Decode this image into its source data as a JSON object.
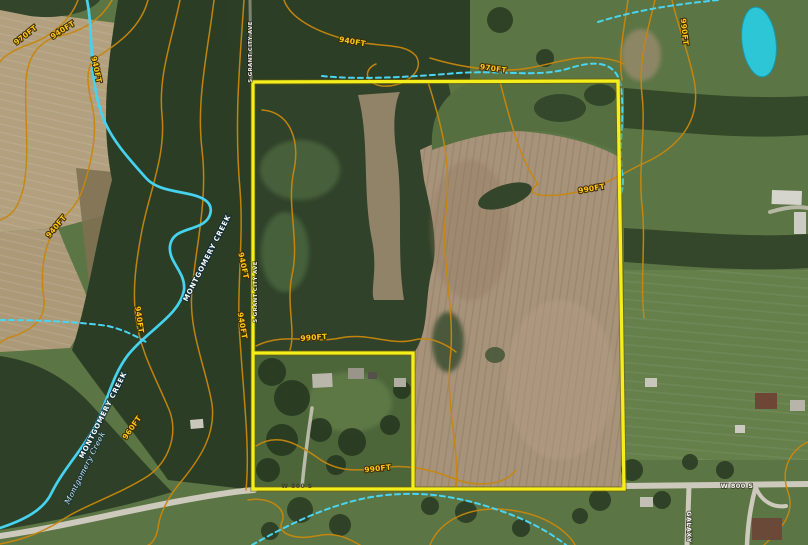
{
  "map": {
    "type": "aerial-parcel-map",
    "boundary_color": "#f6ee1b",
    "contour_color": "#c8870d",
    "creek_color": "#46d3f0",
    "pond_color": "#2cc6d6",
    "contour_labels": [
      {
        "text": "970FT",
        "x": 27,
        "y": 37,
        "r": -38
      },
      {
        "text": "940FT",
        "x": 64,
        "y": 32,
        "r": -33
      },
      {
        "text": "940FT",
        "x": 94,
        "y": 70,
        "r": 78
      },
      {
        "text": "940FT",
        "x": 352,
        "y": 44,
        "r": 10
      },
      {
        "text": "970FT",
        "x": 493,
        "y": 71,
        "r": 8
      },
      {
        "text": "990FT",
        "x": 682,
        "y": 32,
        "r": 84
      },
      {
        "text": "990FT",
        "x": 592,
        "y": 191,
        "r": -10
      },
      {
        "text": "940FT",
        "x": 241,
        "y": 266,
        "r": 78
      },
      {
        "text": "940FT",
        "x": 58,
        "y": 228,
        "r": -50
      },
      {
        "text": "940FT",
        "x": 137,
        "y": 320,
        "r": 82
      },
      {
        "text": "940FT",
        "x": 240,
        "y": 326,
        "r": 80
      },
      {
        "text": "990FT",
        "x": 314,
        "y": 340,
        "r": -4
      },
      {
        "text": "990FT",
        "x": 378,
        "y": 471,
        "r": -6
      },
      {
        "text": "960FT",
        "x": 134,
        "y": 429,
        "r": -55
      }
    ],
    "creek_labels": [
      {
        "text": "MONTGOMERY CREEK",
        "x": 209,
        "y": 259,
        "r": -63,
        "style": "creek-bold"
      },
      {
        "text": "MONTGOMERY CREEK",
        "x": 105,
        "y": 416,
        "r": -63,
        "style": "creek-bold"
      },
      {
        "text": "Montgomery Creek",
        "x": 87,
        "y": 469,
        "r": -63,
        "style": "creek-italic"
      }
    ],
    "road_labels": [
      {
        "text": "W 800 S",
        "x": 737,
        "y": 488,
        "r": 0,
        "style": "road-light"
      },
      {
        "text": "W 800 S",
        "x": 297,
        "y": 488,
        "r": 0,
        "style": "road-dark"
      },
      {
        "text": "GALAXY",
        "x": 687,
        "y": 527,
        "r": 90,
        "style": "road-light"
      },
      {
        "text": "S GRANT CITY AVE",
        "x": 252,
        "y": 52,
        "r": -90,
        "style": "road-tiny"
      },
      {
        "text": "S GRANT CITY AVE",
        "x": 257,
        "y": 292,
        "r": -90,
        "style": "road-tiny"
      }
    ]
  }
}
